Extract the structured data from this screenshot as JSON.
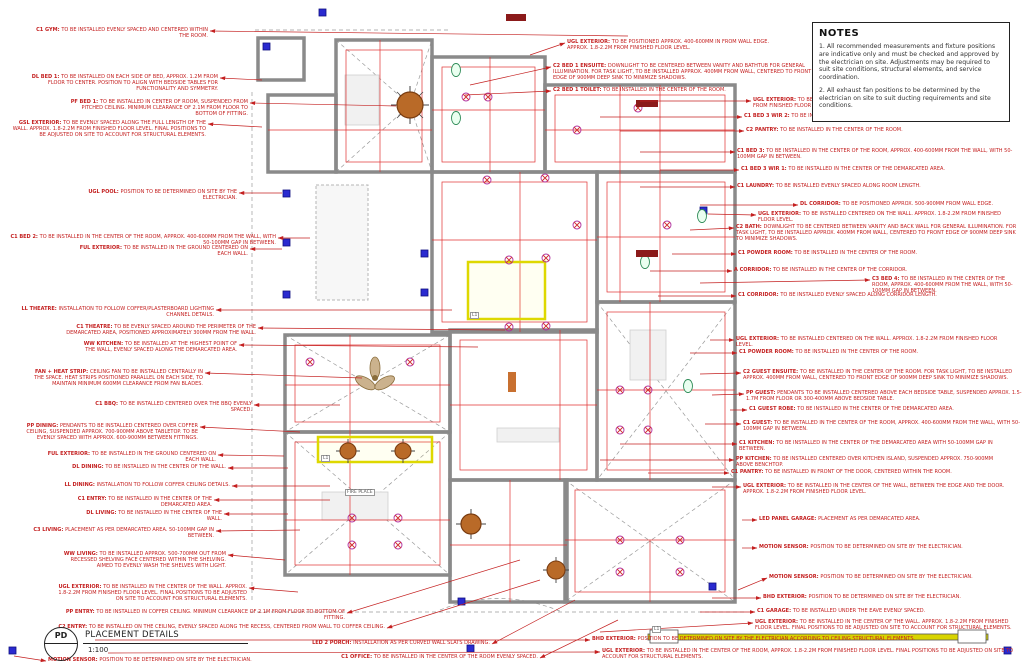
{
  "notes": {
    "title": "NOTES",
    "paragraphs": [
      "1. All recommended measurements and fixture positions are indicative only and must be checked and approved by the electrician on site. Adjustments may be required to suit site conditions, structural elements, and service coordination.",
      "2. All exhaust fan positions to be determined by the electrician on site to suit ducting requirements and site conditions."
    ]
  },
  "title_block": {
    "code": "PD",
    "title": "PLACEMENT DETAILS",
    "scale": "1:100"
  },
  "plan_labels": [
    {
      "text": "L1",
      "x": 470,
      "y": 312
    },
    {
      "text": "L1",
      "x": 321,
      "y": 455
    },
    {
      "text": "L1",
      "x": 652,
      "y": 626
    },
    {
      "text": "FIRE PLACE",
      "x": 345,
      "y": 489
    }
  ],
  "annotations": [
    {
      "l": "C1 GYM:",
      "t": "TO BE INSTALLED EVENLY SPACED AND CENTERED WITHIN THE ROOM.",
      "x": 208,
      "y": 28,
      "w": 180,
      "a": "r",
      "ax": 628,
      "ay": 36
    },
    {
      "l": "DL BED 1:",
      "t": "TO BE INSTALLED ON EACH SIDE OF BED, APPROX. 1.2M FROM FLOOR TO CENTER. POSITION TO ALIGN WITH BEDSIDE TABLES FOR FUNCTIONALITY AND SYMMETRY.",
      "x": 218,
      "y": 75,
      "w": 190,
      "a": "r",
      "ax": 262,
      "ay": 80
    },
    {
      "l": "PF BED 1:",
      "t": "TO BE INSTALLED IN CENTER OF ROOM, SUSPENDED FROM PITCHED CEILING. MINIMUM CLEARANCE OF 2.1M FROM FLOOR TO BOTTOM OF FITTING.",
      "x": 248,
      "y": 100,
      "w": 180,
      "a": "r",
      "ax": 396,
      "ay": 106
    },
    {
      "l": "GSL EXTERIOR:",
      "t": "TO BE EVENLY SPACED ALONG THE FULL LENGTH OF THE WALL. APPROX. 1.8-2.2M FROM FINISHED FLOOR LEVEL. FINAL POSITIONS TO BE ADJUSTED ON SITE TO ACCOUNT FOR STRUCTURAL ELEMENTS.",
      "x": 206,
      "y": 121,
      "w": 196,
      "a": "r",
      "ax": 262,
      "ay": 127
    },
    {
      "l": "UGL POOL:",
      "t": "POSITION TO BE DETERMINED ON SITE BY THE ELECTRICIAN.",
      "x": 237,
      "y": 190,
      "w": 172,
      "a": "r",
      "ax": 282,
      "ay": 193
    },
    {
      "l": "C1 BED 2:",
      "t": "TO BE INSTALLED IN THE CENTER OF THE ROOM, APPROX. 400-600MM FROM THE WALL, WITH 50-100MM GAP IN BETWEEN.",
      "x": 276,
      "y": 235,
      "w": 272,
      "a": "r",
      "ax": 310,
      "ay": 238
    },
    {
      "l": "FUL EXTERIOR:",
      "t": "TO BE INSTALLED IN THE GROUND CENTERED ON EACH WALL.",
      "x": 248,
      "y": 246,
      "w": 180,
      "a": "r",
      "ax": 282,
      "ay": 249
    },
    {
      "l": "LL THEATRE:",
      "t": "INSTALLATION TO FOLLOW COFFER/PLASTERBOARD LIGHTING CHANNEL DETAILS.",
      "x": 214,
      "y": 307,
      "w": 196,
      "a": "r",
      "ax": 452,
      "ay": 310
    },
    {
      "l": "C1 THEATRE:",
      "t": "TO BE EVENLY SPACED AROUND THE PERIMETER OF THE DEMARCATED AREA, POSITIONED APPROXIMATELY 300MM FROM THE WALL.",
      "x": 256,
      "y": 325,
      "w": 192,
      "a": "r",
      "ax": 505,
      "ay": 330
    },
    {
      "l": "WW KITCHEN:",
      "t": "TO BE INSTALLED AT THE HIGHEST POINT OF THE WALL, EVENLY SPACED ALONG THE DEMARCATED AREA.",
      "x": 237,
      "y": 342,
      "w": 162,
      "a": "r",
      "ax": 478,
      "ay": 347
    },
    {
      "l": "FAN + HEAT STRIP:",
      "t": "CEILING FAN TO BE INSTALLED CENTRALLY IN THE SPACE. HEAT STRIPS POSITIONED PARALLEL ON EACH SIDE, TO MAINTAIN MINIMUM 600MM CLEARANCE FROM FAN BLADES.",
      "x": 203,
      "y": 370,
      "w": 172,
      "a": "r",
      "ax": 362,
      "ay": 378
    },
    {
      "l": "C1 BBQ:",
      "t": "TO BE INSTALLED CENTERED OVER THE BBQ EVENLY SPACED.",
      "x": 252,
      "y": 402,
      "w": 162,
      "a": "r",
      "ax": 340,
      "ay": 405
    },
    {
      "l": "PP DINING:",
      "t": "PENDANTS TO BE INSTALLED CENTERED OVER COFFER CEILING, SUSPENDED APPROX. 700-900MM ABOVE TABLETOP. TO BE EVENLY SPACED WITH APPROX. 600-900MM BETWEEN FITTINGS.",
      "x": 198,
      "y": 424,
      "w": 176,
      "a": "r",
      "ax": 300,
      "ay": 432
    },
    {
      "l": "FUL EXTERIOR:",
      "t": "TO BE INSTALLED IN THE GROUND CENTERED ON EACH WALL.",
      "x": 216,
      "y": 452,
      "w": 182,
      "a": "r",
      "ax": 284,
      "ay": 456
    },
    {
      "l": "DL DINING:",
      "t": "TO BE INSTALLED IN THE CENTER OF THE WALL.",
      "x": 226,
      "y": 465,
      "w": 162,
      "a": "r",
      "ax": 288,
      "ay": 468
    },
    {
      "l": "LL DINING:",
      "t": "INSTALLATION TO FOLLOW COFFER CEILING DETAILS.",
      "x": 230,
      "y": 483,
      "w": 166,
      "a": "r",
      "ax": 330,
      "ay": 486
    },
    {
      "l": "C1 ENTRY:",
      "t": "TO BE INSTALLED IN THE CENTER OF THE DEMARCATED AREA.",
      "x": 212,
      "y": 497,
      "w": 166,
      "a": "r",
      "ax": 330,
      "ay": 500
    },
    {
      "l": "DL LIVING:",
      "t": "TO BE INSTALLED IN THE CENTER OF THE WALL.",
      "x": 222,
      "y": 511,
      "w": 152,
      "a": "r",
      "ax": 288,
      "ay": 514
    },
    {
      "l": "C3 LIVING:",
      "t": "PLACEMENT AS PER DEMARCATED AREA. 50-100MM GAP IN BETWEEN.",
      "x": 214,
      "y": 528,
      "w": 182,
      "a": "r",
      "ax": 300,
      "ay": 530
    },
    {
      "l": "WW LIVING:",
      "t": "TO BE INSTALLED APPROX. 500-700MM OUT FROM RECESSED SHELVING FACE CENTERED WITHIN THE SHELVING. AIMED TO EVENLY WASH THE SHELVES WITH LIGHT.",
      "x": 226,
      "y": 552,
      "w": 168,
      "a": "r",
      "ax": 285,
      "ay": 560
    },
    {
      "l": "UGL EXTERIOR:",
      "t": "TO BE INSTALLED IN THE CENTER OF THE WALL. APPROX. 1.8-2.2M FROM FINISHED FLOOR LEVEL. FINAL POSITIONS TO BE ADJUSTED ON SITE TO ACCOUNT FOR STRUCTURAL ELEMENTS.",
      "x": 247,
      "y": 585,
      "w": 192,
      "a": "r",
      "ax": 298,
      "ay": 592
    },
    {
      "l": "PP ENTRY:",
      "t": "TO BE INSTALLED IN COFFER CEILING. MINIMUM CLEARANCE OF 2.1M FROM FLOOR TO BOTTOM OF FITTING.",
      "x": 345,
      "y": 610,
      "w": 292,
      "a": "r",
      "ax": 520,
      "ay": 560
    },
    {
      "l": "C2 ENTRY:",
      "t": "TO BE INSTALLED ON THE CEILING, EVENLY SPACED ALONG THE RECESS, CENTERED FROM WALL TO COFFER CEILING.",
      "x": 385,
      "y": 625,
      "w": 332,
      "a": "r",
      "ax": 540,
      "ay": 580
    },
    {
      "l": "LED 2 PORCH:",
      "t": "INSTALLATION AS PER CURVED WALL SLATS DRAWING.",
      "x": 490,
      "y": 641,
      "w": 232,
      "a": "r",
      "ax": 575,
      "ay": 600
    },
    {
      "l": "C1 OFFICE:",
      "t": "TO BE INSTALLED IN THE CENTER OF THE ROOM EVENLY SPACED.",
      "x": 538,
      "y": 655,
      "w": 252,
      "a": "r",
      "ax": 618,
      "ay": 620
    },
    {
      "l": "UGL EXTERIOR:",
      "t": "TO BE POSITIONED APPROX. 400-600MM IN FROM WALL EDGE. APPROX. 1.8-2.2M FROM FINISHED FLOOR LEVEL.",
      "x": 567,
      "y": 40,
      "w": 218,
      "a": "l",
      "ax": 530,
      "ay": 55
    },
    {
      "l": "C2 BED 1 ENSUITE:",
      "t": "DOWNLIGHT TO BE CENTERED BETWEEN VANITY AND BATHTUB FOR GENERAL ILLUMINATION. FOR TASK LIGHT, TO BE INSTALLED APPROX. 400MM FROM WALL, CENTERED TO FRONT EDGE OF 900MM DEEP SINK TO MINIMIZE SHADOWS.",
      "x": 553,
      "y": 64,
      "w": 262,
      "a": "l",
      "ax": 470,
      "ay": 85
    },
    {
      "l": "C2 BED 1 TOILET:",
      "t": "TO BE INSTALLED IN THE CENTER OF THE ROOM.",
      "x": 553,
      "y": 88,
      "w": 222,
      "a": "l",
      "ax": 465,
      "ay": 95
    },
    {
      "l": "UGL EXTERIOR:",
      "t": "TO BE POSITIONED APPROX. 400-600MM IN FROM WALL EDGE. APPROX. 1.8-2.2M FROM FINISHED FLOOR LEVEL.",
      "x": 753,
      "y": 98,
      "w": 262,
      "a": "l",
      "ax": 640,
      "ay": 101
    },
    {
      "l": "C1 BED 3 WIR 2:",
      "t": "TO BE INSTALLED IN THE CENTER OF THE ROOM.",
      "x": 744,
      "y": 114,
      "w": 232,
      "a": "l",
      "ax": 600,
      "ay": 117
    },
    {
      "l": "C2 PANTRY:",
      "t": "TO BE INSTALLED IN THE CENTER OF THE ROOM.",
      "x": 746,
      "y": 128,
      "w": 222,
      "a": "l",
      "ax": 620,
      "ay": 131
    },
    {
      "l": "C1 BED 3:",
      "t": "TO BE INSTALLED IN THE CENTER OF THE ROOM, APPROX. 400-600MM FROM THE WALL, WITH 50-100MM GAP IN BETWEEN.",
      "x": 737,
      "y": 149,
      "w": 282,
      "a": "l",
      "ax": 640,
      "ay": 152
    },
    {
      "l": "C1 BED 3 WIR 1:",
      "t": "TO BE INSTALLED IN THE CENTER OF THE DEMARCATED AREA.",
      "x": 741,
      "y": 167,
      "w": 242,
      "a": "l",
      "ax": 660,
      "ay": 170
    },
    {
      "l": "C1 LAUNDRY:",
      "t": "TO BE INSTALLED EVENLY SPACED ALONG ROOM LENGTH.",
      "x": 737,
      "y": 184,
      "w": 232,
      "a": "l",
      "ax": 640,
      "ay": 187
    },
    {
      "l": "DL CORRIDOR:",
      "t": "TO BE POSITIONED APPROX. 500-900MM FROM WALL EDGE.",
      "x": 800,
      "y": 202,
      "w": 220,
      "a": "l",
      "ax": 700,
      "ay": 205
    },
    {
      "l": "UGL EXTERIOR:",
      "t": "TO BE INSTALLED CENTERED ON THE WALL. APPROX. 1.8-2.2M FROM FINISHED FLOOR LEVEL.",
      "x": 758,
      "y": 212,
      "w": 260,
      "a": "l",
      "ax": 708,
      "ay": 214
    },
    {
      "l": "C2 BATH:",
      "t": "DOWNLIGHT TO BE CENTERED BETWEEN VANITY AND BACK WALL FOR GENERAL ILLUMINATION. FOR TASK LIGHT, TO BE INSTALLED APPROX. 400MM FROM WALL, CENTERED TO FRONT EDGE OF 900MM DEEP SINK TO MINIMIZE SHADOWS.",
      "x": 736,
      "y": 225,
      "w": 286,
      "a": "l",
      "ax": 690,
      "ay": 230
    },
    {
      "l": "C1 POWDER ROOM:",
      "t": "TO BE INSTALLED IN THE CENTER OF THE ROOM.",
      "x": 738,
      "y": 251,
      "w": 232,
      "a": "l",
      "ax": 672,
      "ay": 254
    },
    {
      "l": "A CORRIDOR:",
      "t": "TO BE INSTALLED IN THE CENTER OF THE CORRIDOR.",
      "x": 734,
      "y": 268,
      "w": 232,
      "a": "l",
      "ax": 650,
      "ay": 271
    },
    {
      "l": "C3 BED 4:",
      "t": "TO BE INSTALLED IN THE CENTER OF THE ROOM, APPROX. 400-600MM FROM THE WALL, WITH 50-100MM GAP IN BETWEEN.",
      "x": 872,
      "y": 277,
      "w": 150,
      "a": "l",
      "ax": 700,
      "ay": 283
    },
    {
      "l": "C1 CORRIDOR:",
      "t": "TO BE INSTALLED EVENLY SPACED ALONG CORRIDOR LENGTH.",
      "x": 738,
      "y": 293,
      "w": 242,
      "a": "l",
      "ax": 658,
      "ay": 296
    },
    {
      "l": "UGL EXTERIOR:",
      "t": "TO BE INSTALLED CENTERED ON THE WALL. APPROX. 1.8-2.2M FROM FINISHED FLOOR LEVEL.",
      "x": 736,
      "y": 337,
      "w": 262,
      "a": "l",
      "ax": 710,
      "ay": 340
    },
    {
      "l": "C1 POWDER ROOM:",
      "t": "TO BE INSTALLED IN THE CENTER OF THE ROOM.",
      "x": 739,
      "y": 350,
      "w": 232,
      "a": "l",
      "ax": 690,
      "ay": 353
    },
    {
      "l": "C2 GUEST ENSUITE:",
      "t": "TO BE INSTALLED IN THE CENTER OF THE ROOM. FOR TASK LIGHT, TO BE INSTALLED APPROX. 400MM FROM WALL, CENTERED TO FRONT EDGE OF 900MM DEEP SINK TO MINIMIZE SHADOWS.",
      "x": 743,
      "y": 370,
      "w": 282,
      "a": "l",
      "ax": 700,
      "ay": 374
    },
    {
      "l": "PP GUEST:",
      "t": "PENDANTS TO BE INSTALLED CENTERED ABOVE EACH BEDSIDE TABLE, SUSPENDED APPROX. 1.5-1.7M FROM FLOOR OR 300-400MM ABOVE BEDSIDE TABLE.",
      "x": 746,
      "y": 391,
      "w": 282,
      "a": "l",
      "ax": 712,
      "ay": 395
    },
    {
      "l": "C1 GUEST ROBE:",
      "t": "TO BE INSTALLED IN THE CENTER OF THE DEMARCATED AREA.",
      "x": 749,
      "y": 407,
      "w": 242,
      "a": "l",
      "ax": 730,
      "ay": 410
    },
    {
      "l": "C1 GUEST:",
      "t": "TO BE INSTALLED IN THE CENTER OF THE ROOM, APPROX. 400-600MM FROM THE WALL, WITH 50-100MM GAP IN BETWEEN.",
      "x": 743,
      "y": 421,
      "w": 282,
      "a": "l",
      "ax": 705,
      "ay": 424
    },
    {
      "l": "C1 KITCHEN:",
      "t": "TO BE INSTALLED IN THE CENTER OF THE DEMARCATED AREA WITH 50-100MM GAP IN BETWEEN.",
      "x": 739,
      "y": 441,
      "w": 262,
      "a": "l",
      "ax": 620,
      "ay": 444
    },
    {
      "l": "PP KITCHEN:",
      "t": "TO BE INSTALLED CENTERED OVER KITCHEN ISLAND, SUSPENDED APPROX. 750-900MM ABOVE BENCHTOP.",
      "x": 736,
      "y": 457,
      "w": 272,
      "a": "l",
      "ax": 600,
      "ay": 460
    },
    {
      "l": "C1 PANTRY:",
      "t": "TO BE INSTALLED IN FRONT OF THE DOOR, CENTERED WITHIN THE ROOM.",
      "x": 731,
      "y": 470,
      "w": 252,
      "a": "l",
      "ax": 648,
      "ay": 473
    },
    {
      "l": "UGL EXTERIOR:",
      "t": "TO BE INSTALLED IN THE CENTER OF THE WALL, BETWEEN THE EDGE AND THE DOOR. APPROX. 1.8-2.2M FROM FINISHED FLOOR LEVEL.",
      "x": 743,
      "y": 484,
      "w": 282,
      "a": "l",
      "ax": 712,
      "ay": 487
    },
    {
      "l": "LED PANEL GARAGE:",
      "t": "PLACEMENT AS PER DEMARCATED AREA.",
      "x": 759,
      "y": 517,
      "w": 232,
      "a": "l",
      "ax": 742,
      "ay": 520
    },
    {
      "l": "MOTION SENSOR:",
      "t": "POSITION TO BE DETERMINED ON SITE BY THE ELECTRICIAN.",
      "x": 759,
      "y": 545,
      "w": 252,
      "a": "l",
      "ax": 742,
      "ay": 548
    },
    {
      "l": "MOTION SENSOR:",
      "t": "POSITION TO BE DETERMINED ON SITE BY THE ELECTRICIAN.",
      "x": 769,
      "y": 575,
      "w": 252,
      "a": "l",
      "ax": 738,
      "ay": 590
    },
    {
      "l": "BHD EXTERIOR:",
      "t": "POSITION TO BE DETERMINED ON SITE BY THE ELECTRICIAN.",
      "x": 763,
      "y": 595,
      "w": 252,
      "a": "l",
      "ax": 712,
      "ay": 598
    },
    {
      "l": "C1 GARAGE:",
      "t": "TO BE INSTALLED UNDER THE EAVE EVENLY SPACED.",
      "x": 757,
      "y": 609,
      "w": 242,
      "a": "l",
      "ax": 700,
      "ay": 612
    },
    {
      "l": "UGL EXTERIOR:",
      "t": "TO BE INSTALLED IN THE CENTER OF THE WALL. APPROX. 1.8-2.2M FROM FINISHED FLOOR LEVEL. FINAL POSITIONS TO BE ADJUSTED ON SITE TO ACCOUNT FOR STRUCTURAL ELEMENTS.",
      "x": 755,
      "y": 620,
      "w": 266,
      "a": "l",
      "ax": 600,
      "ay": 632
    },
    {
      "l": "BHD EXTERIOR:",
      "t": "POSITION TO BE DETERMINED ON SITE BY THE ELECTRICIAN ACCORDING TO CEILING STRUCTURAL ELEMENTS.",
      "x": 592,
      "y": 637,
      "w": 432,
      "a": "l",
      "ax": 95,
      "ay": 640
    },
    {
      "l": "UGL EXTERIOR:",
      "t": "TO BE INSTALLED IN THE CENTER OF THE ROOM, APPROX. 1.8-2.2M FROM FINISHED FLOOR LEVEL. FINAL POSITIONS TO BE ADJUSTED ON SITE TO ACCOUNT FOR STRUCTURAL ELEMENTS.",
      "x": 602,
      "y": 649,
      "w": 420,
      "a": "l",
      "ax": 108,
      "ay": 653
    },
    {
      "l": "MOTION SENSOR:",
      "t": "POSITION TO BE DETERMINED ON SITE BY THE ELECTRICIAN.",
      "x": 48,
      "y": 658,
      "w": 302,
      "a": "l",
      "ax": 14,
      "ay": 656
    }
  ]
}
